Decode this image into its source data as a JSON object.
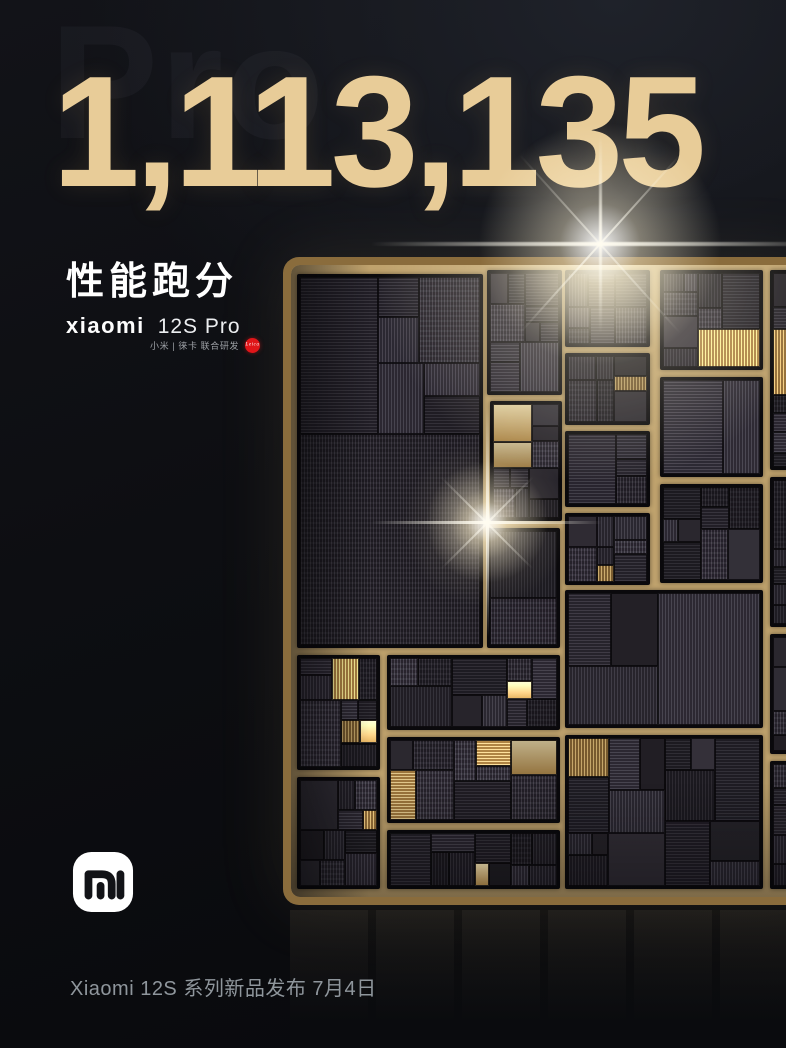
{
  "poster": {
    "watermark": "Pro",
    "score": "1,113,135",
    "score_label": "性能跑分",
    "brand_wordmark": "xiaomi",
    "model_name": "12S Pro",
    "coop_line": "小米 | 徕卡 联合研发",
    "leica_label": "Leica",
    "footer": "Xiaomi 12S 系列新品发布 7月4日"
  },
  "colors": {
    "score_gold": "#e8cc98",
    "label_white": "#ffffff",
    "leica_red": "#e01318",
    "footer_gray": "#8f969c",
    "chip_frame_gold": "#e3cd9a",
    "die_gutter_gold": "#c2a571",
    "background": "#0e0f13"
  }
}
